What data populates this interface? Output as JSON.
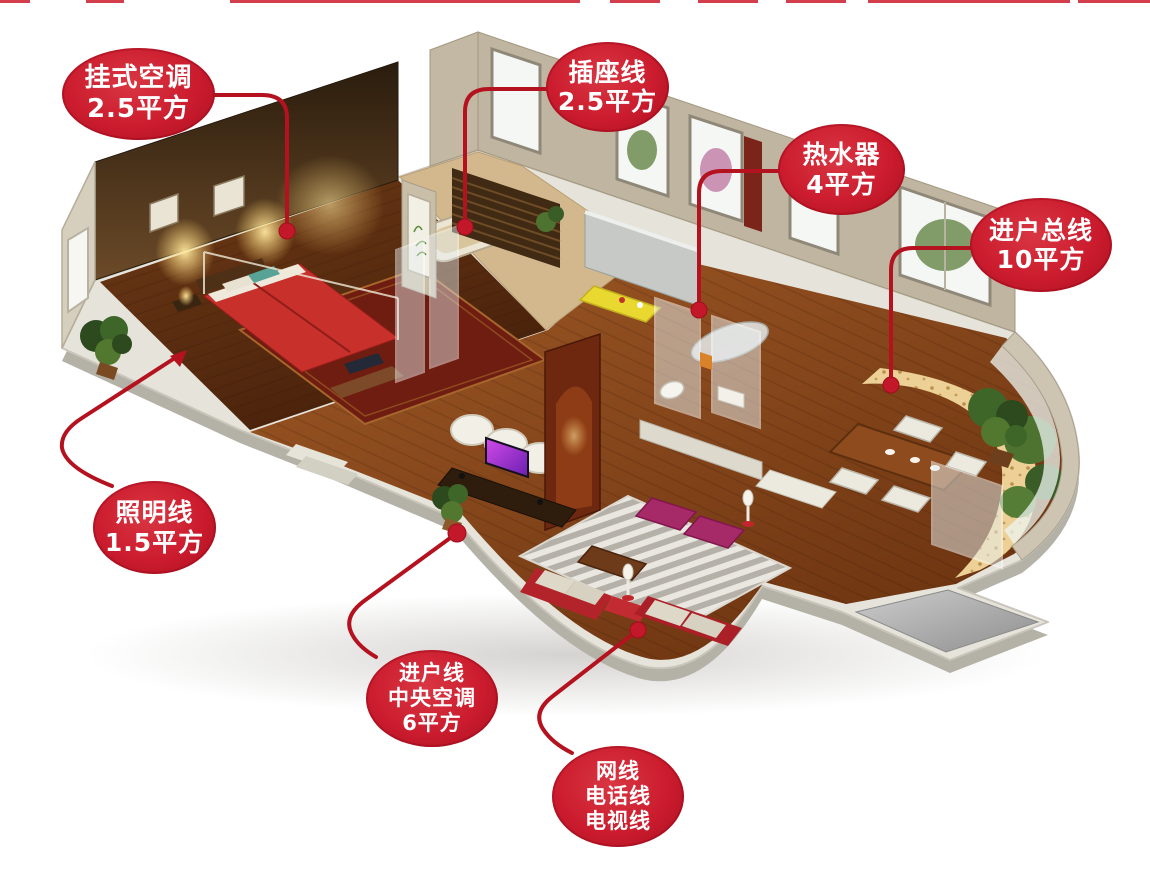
{
  "colors": {
    "accent_red": "#cb1c2e",
    "line_red": "#b5121f",
    "dot_red": "#c2182a",
    "callout_text": "#ffffff",
    "background": "#ffffff"
  },
  "callouts": [
    {
      "id": "wall-ac",
      "lines": [
        "挂式空调",
        "2.5平方"
      ]
    },
    {
      "id": "socket-wire",
      "lines": [
        "插座线",
        "2.5平方"
      ]
    },
    {
      "id": "water-heater",
      "lines": [
        "热水器",
        "4平方"
      ]
    },
    {
      "id": "service-entrance",
      "lines": [
        "进户总线",
        "10平方"
      ]
    },
    {
      "id": "lighting-wire",
      "lines": [
        "照明线",
        "1.5平方"
      ]
    },
    {
      "id": "entry-central-ac",
      "lines": [
        "进户线",
        "中央空调",
        "6平方"
      ]
    },
    {
      "id": "network-phone-tv",
      "lines": [
        "网线",
        "电话线",
        "电视线"
      ]
    }
  ],
  "scene": {
    "type": "isometric-apartment-cutaway",
    "areas": [
      "bedroom",
      "bathroom",
      "kitchen",
      "second-bathroom",
      "dining-area",
      "living-room",
      "balcony",
      "entrance"
    ]
  }
}
